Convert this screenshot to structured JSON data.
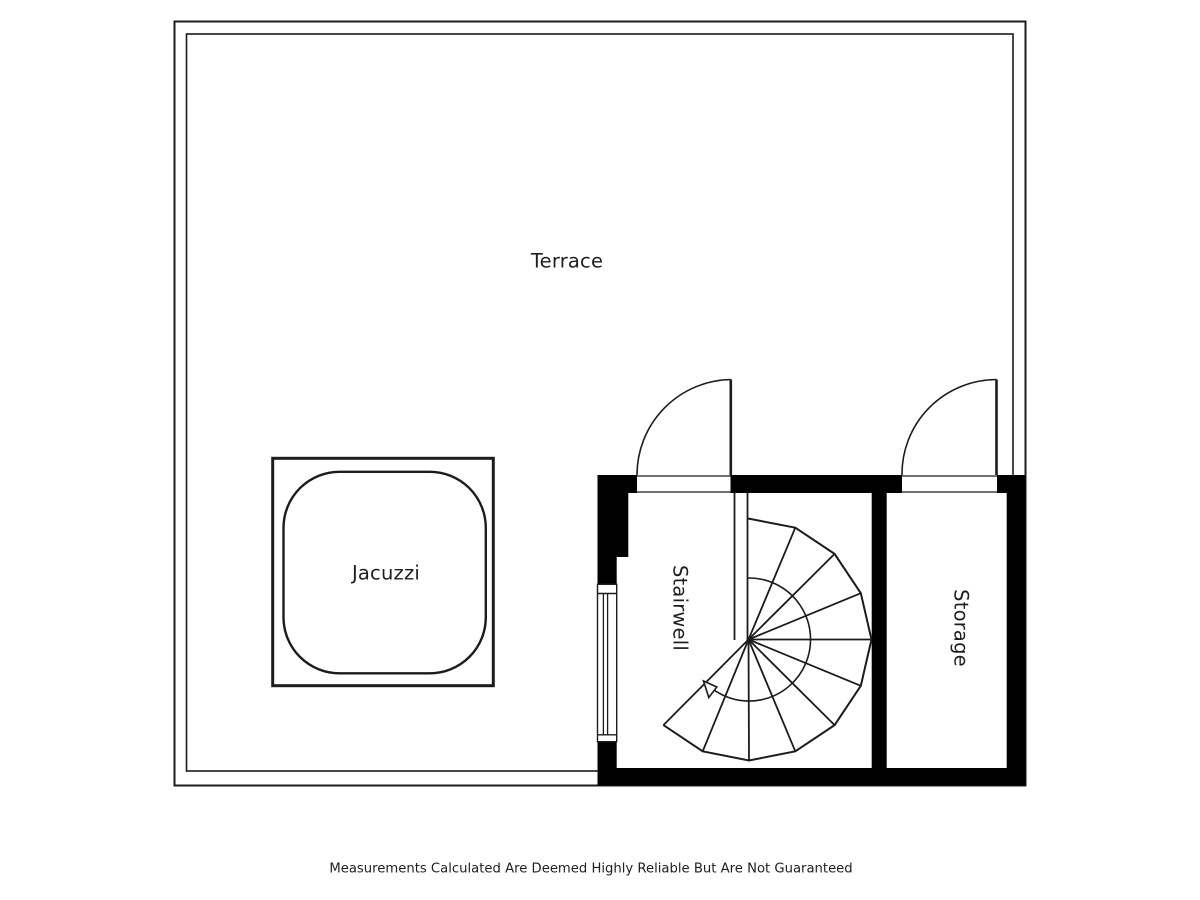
{
  "page": {
    "background_color": "#ffffff",
    "line_color": "#1c1c1c",
    "wall_fill_color": "#000000",
    "text_color": "#1f1f1f"
  },
  "floorplan": {
    "type": "floor-plan",
    "rooms": {
      "terrace": {
        "label": "Terrace"
      },
      "jacuzzi": {
        "label": "Jacuzzi"
      },
      "stairwell": {
        "label": "Stairwell"
      },
      "storage": {
        "label": "Storage"
      }
    },
    "features": {
      "doors": [
        "stairwell-door",
        "storage-door"
      ],
      "window": "stairwell-left-window",
      "staircase": "spiral-staircase",
      "direction_arrow": "stair-direction-arrow"
    }
  },
  "footer": {
    "disclaimer": "Measurements Calculated Are Deemed Highly Reliable But Are Not Guaranteed"
  }
}
